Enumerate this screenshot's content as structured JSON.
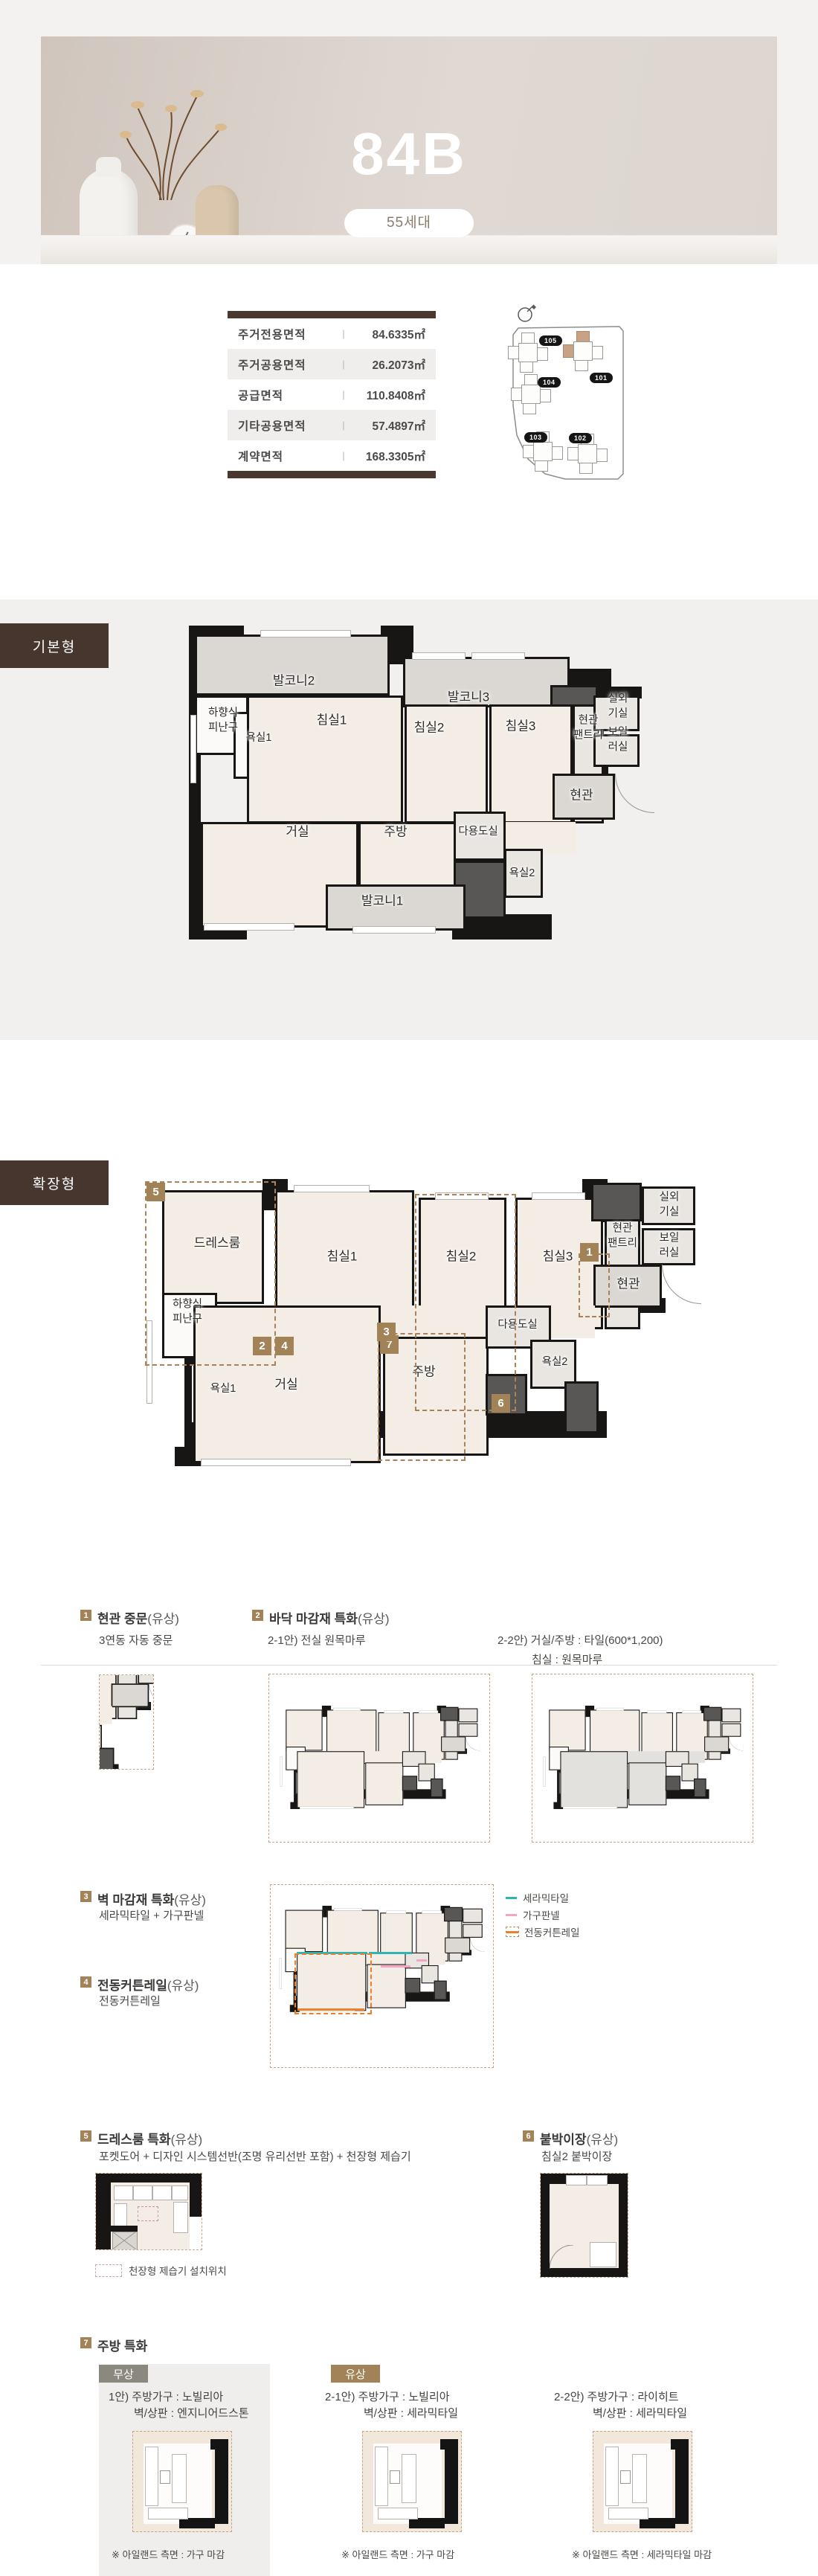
{
  "hero": {
    "title": "84B",
    "units_badge": "55세대"
  },
  "area_table": {
    "rows": [
      {
        "label": "주거전용면적",
        "value": "84.6335㎡"
      },
      {
        "label": "주거공용면적",
        "value": "26.2073㎡"
      },
      {
        "label": "공급면적",
        "value": "110.8408㎡"
      },
      {
        "label": "기타공용면적",
        "value": "57.4897㎡"
      },
      {
        "label": "계약면적",
        "value": "168.3305㎡"
      }
    ]
  },
  "site_map": {
    "buildings": [
      "105",
      "101",
      "104",
      "103",
      "102"
    ],
    "highlight_building": "101"
  },
  "plans": {
    "basic": {
      "tag": "기본형",
      "rooms": {
        "balc2": "발코니2",
        "balc3": "발코니3",
        "escape": "하향식\n피난구",
        "bath1": "욕실1",
        "bed1": "침실1",
        "bed2": "침실2",
        "bed3": "침실3",
        "pantry": "현관\n팬트리",
        "outdoor": "실외기실",
        "boiler": "보일러실",
        "entry": "현관",
        "living": "거실",
        "kitchen": "주방",
        "utility": "다용도실",
        "bath2": "욕실2",
        "balc1": "발코니1"
      }
    },
    "expanded": {
      "tag": "확장형",
      "rooms": {
        "dress": "드레스룸",
        "escape": "하향식\n피난구",
        "bath1": "욕실1",
        "bed1": "침실1",
        "bed2": "침실2",
        "bed3": "침실3",
        "pantry": "현관\n팬트리",
        "outdoor": "실외기실",
        "boiler": "보일러실",
        "entry": "현관",
        "living": "거실",
        "kitchen": "주방",
        "utility": "다용도실",
        "bath2": "욕실2"
      },
      "badges": {
        "b1": "1",
        "b2": "2",
        "b3": "3",
        "b4": "4",
        "b5": "5",
        "b6": "6",
        "b7": "7"
      }
    }
  },
  "features": {
    "f1": {
      "num": "1",
      "title": "현관 중문",
      "paid": "(유상)",
      "sub": "3연동 자동 중문"
    },
    "f2": {
      "num": "2",
      "title": "바닥 마감재 특화",
      "paid": "(유상)",
      "option1": "2-1안) 전실 원목마루",
      "option2_line1": "2-2안) 거실/주방 : 타일(600*1,200)",
      "option2_line2": "침실 : 원목마루"
    },
    "f3": {
      "num": "3",
      "title": "벽 마감재 특화",
      "paid": "(유상)",
      "sub": "세라믹타일 + 가구판넬"
    },
    "f4": {
      "num": "4",
      "title": "전동커튼레일",
      "paid": "(유상)",
      "sub": "전동커튼레일"
    },
    "wall_legend": [
      {
        "label": "세라믹타일",
        "color": "#2fb5b0",
        "style": "line"
      },
      {
        "label": "가구판넬",
        "color": "#f2a5c8",
        "style": "line"
      },
      {
        "label": "전동커튼레일",
        "color": "#ee7f2a",
        "style": "dashed-box"
      }
    ],
    "f5": {
      "num": "5",
      "title": "드레스룸 특화",
      "paid": "(유상)",
      "sub": "포켓도어 + 디자인 시스템선반(조명 유리선반 포함) + 천장형 제습기",
      "legend": "천장형 제습기 설치위치"
    },
    "f6": {
      "num": "6",
      "title": "붙박이장",
      "paid": "(유상)",
      "sub": "침실2 붙박이장"
    },
    "f7": {
      "num": "7",
      "title": "주방 특화",
      "free_badge": "무상",
      "paid_badge": "유상",
      "options": [
        {
          "line1": "1안) 주방가구 : 노빌리아",
          "line2": "벽/상판 : 엔지니어드스톤",
          "note": "※ 아일랜드 측면 : 가구 마감"
        },
        {
          "line1": "2-1안) 주방가구 : 노빌리아",
          "line2": "벽/상판 : 세라믹타일",
          "note": "※ 아일랜드 측면 : 가구 마감"
        },
        {
          "line1": "2-2안) 주방가구 : 라이히트",
          "line2": "벽/상판 : 세라믹타일",
          "note": "※ 아일랜드 측면 : 세라믹타일 마감"
        }
      ]
    }
  },
  "colors": {
    "brand_brown": "#46362d",
    "badge_brown": "#a28257",
    "free_gray": "#8b8880",
    "tile_teal": "#2fb5b0",
    "panel_pink": "#f2a5c8",
    "curtain_orange": "#ee7f2a",
    "site_highlight": "#c9a184",
    "floor_beige": "#f4ede5",
    "balcony_gray": "#dbd7d2"
  }
}
